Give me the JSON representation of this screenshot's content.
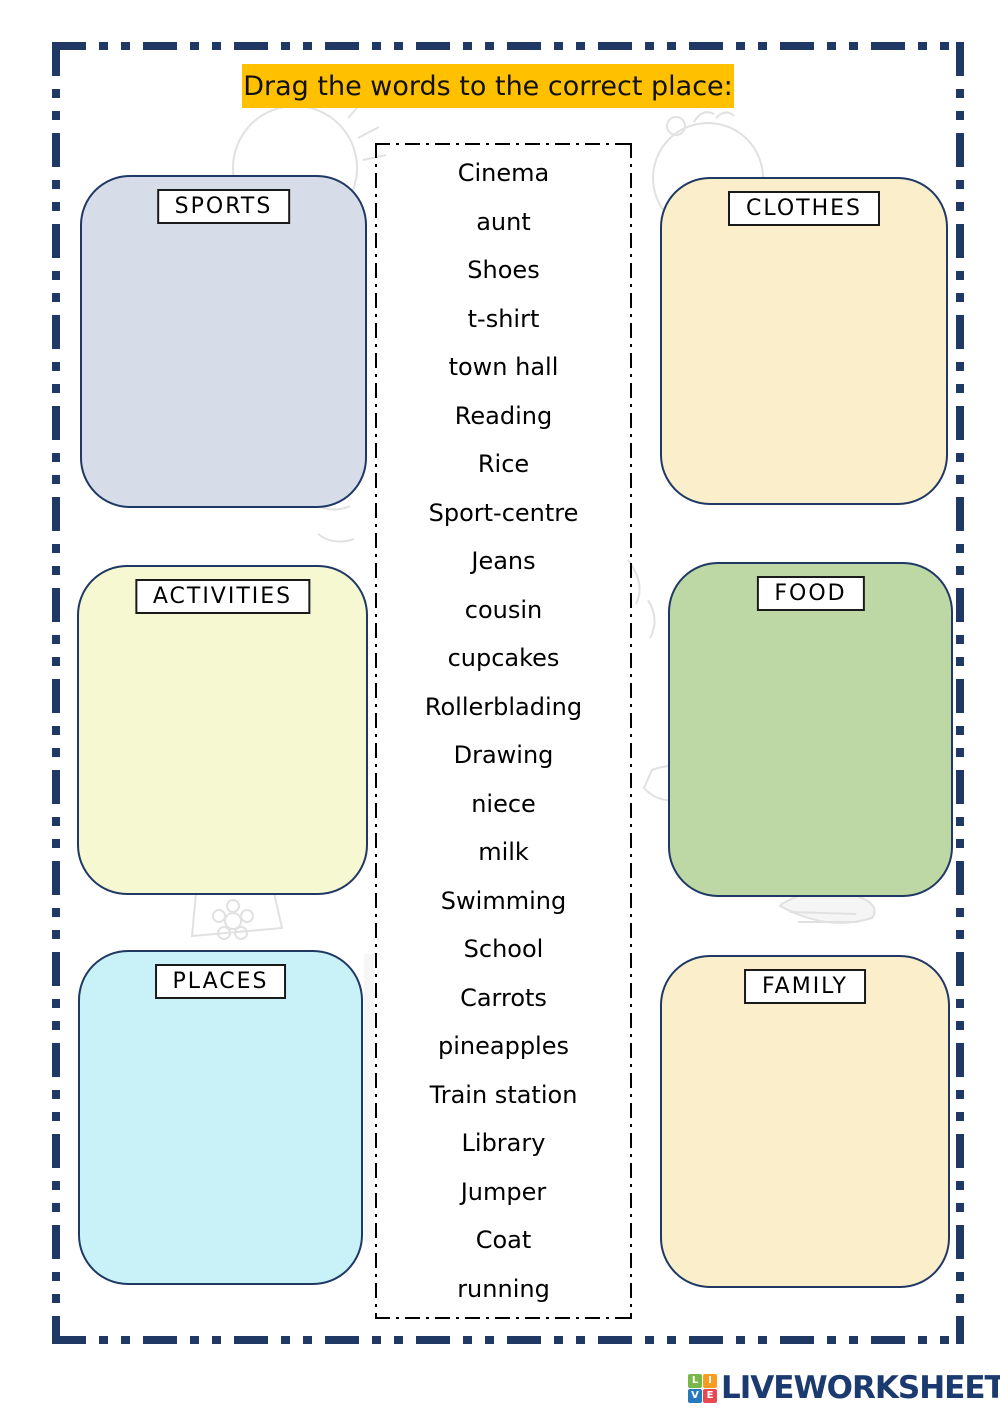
{
  "title": "Drag the words to the correct place:",
  "categories": [
    {
      "id": "sports",
      "label": "SPORTS",
      "fill": "#d6dde9"
    },
    {
      "id": "activities",
      "label": "ACTIVITIES",
      "fill": "#f5f8d0"
    },
    {
      "id": "places",
      "label": "PLACES",
      "fill": "#c8f2f8"
    },
    {
      "id": "clothes",
      "label": "CLOTHES",
      "fill": "#fbeecb"
    },
    {
      "id": "food",
      "label": "FOOD",
      "fill": "#bed8a5"
    },
    {
      "id": "family",
      "label": "FAMILY",
      "fill": "#fbeecb"
    }
  ],
  "words": [
    "Cinema",
    "aunt",
    "Shoes",
    "t-shirt",
    "town hall",
    "Reading",
    "Rice",
    "Sport-centre",
    "Jeans",
    "cousin",
    "cupcakes",
    "Rollerblading",
    "Drawing",
    "niece",
    "milk",
    "Swimming",
    "School",
    "Carrots",
    "pineapples",
    "Train station",
    "Library",
    "Jumper",
    "Coat",
    "running"
  ],
  "footer": {
    "brand": "LIVEWORKSHEETS",
    "logo": [
      {
        "ch": "L",
        "bg": "#7ab648"
      },
      {
        "ch": "I",
        "bg": "#f69c1f"
      },
      {
        "ch": "V",
        "bg": "#2878be"
      },
      {
        "ch": "E",
        "bg": "#e8484f"
      }
    ]
  },
  "colors": {
    "frame_navy": "#1f3864",
    "banner_yellow": "#ffc000",
    "word_text": "#000000",
    "brand_navy": "#1b3a70"
  }
}
